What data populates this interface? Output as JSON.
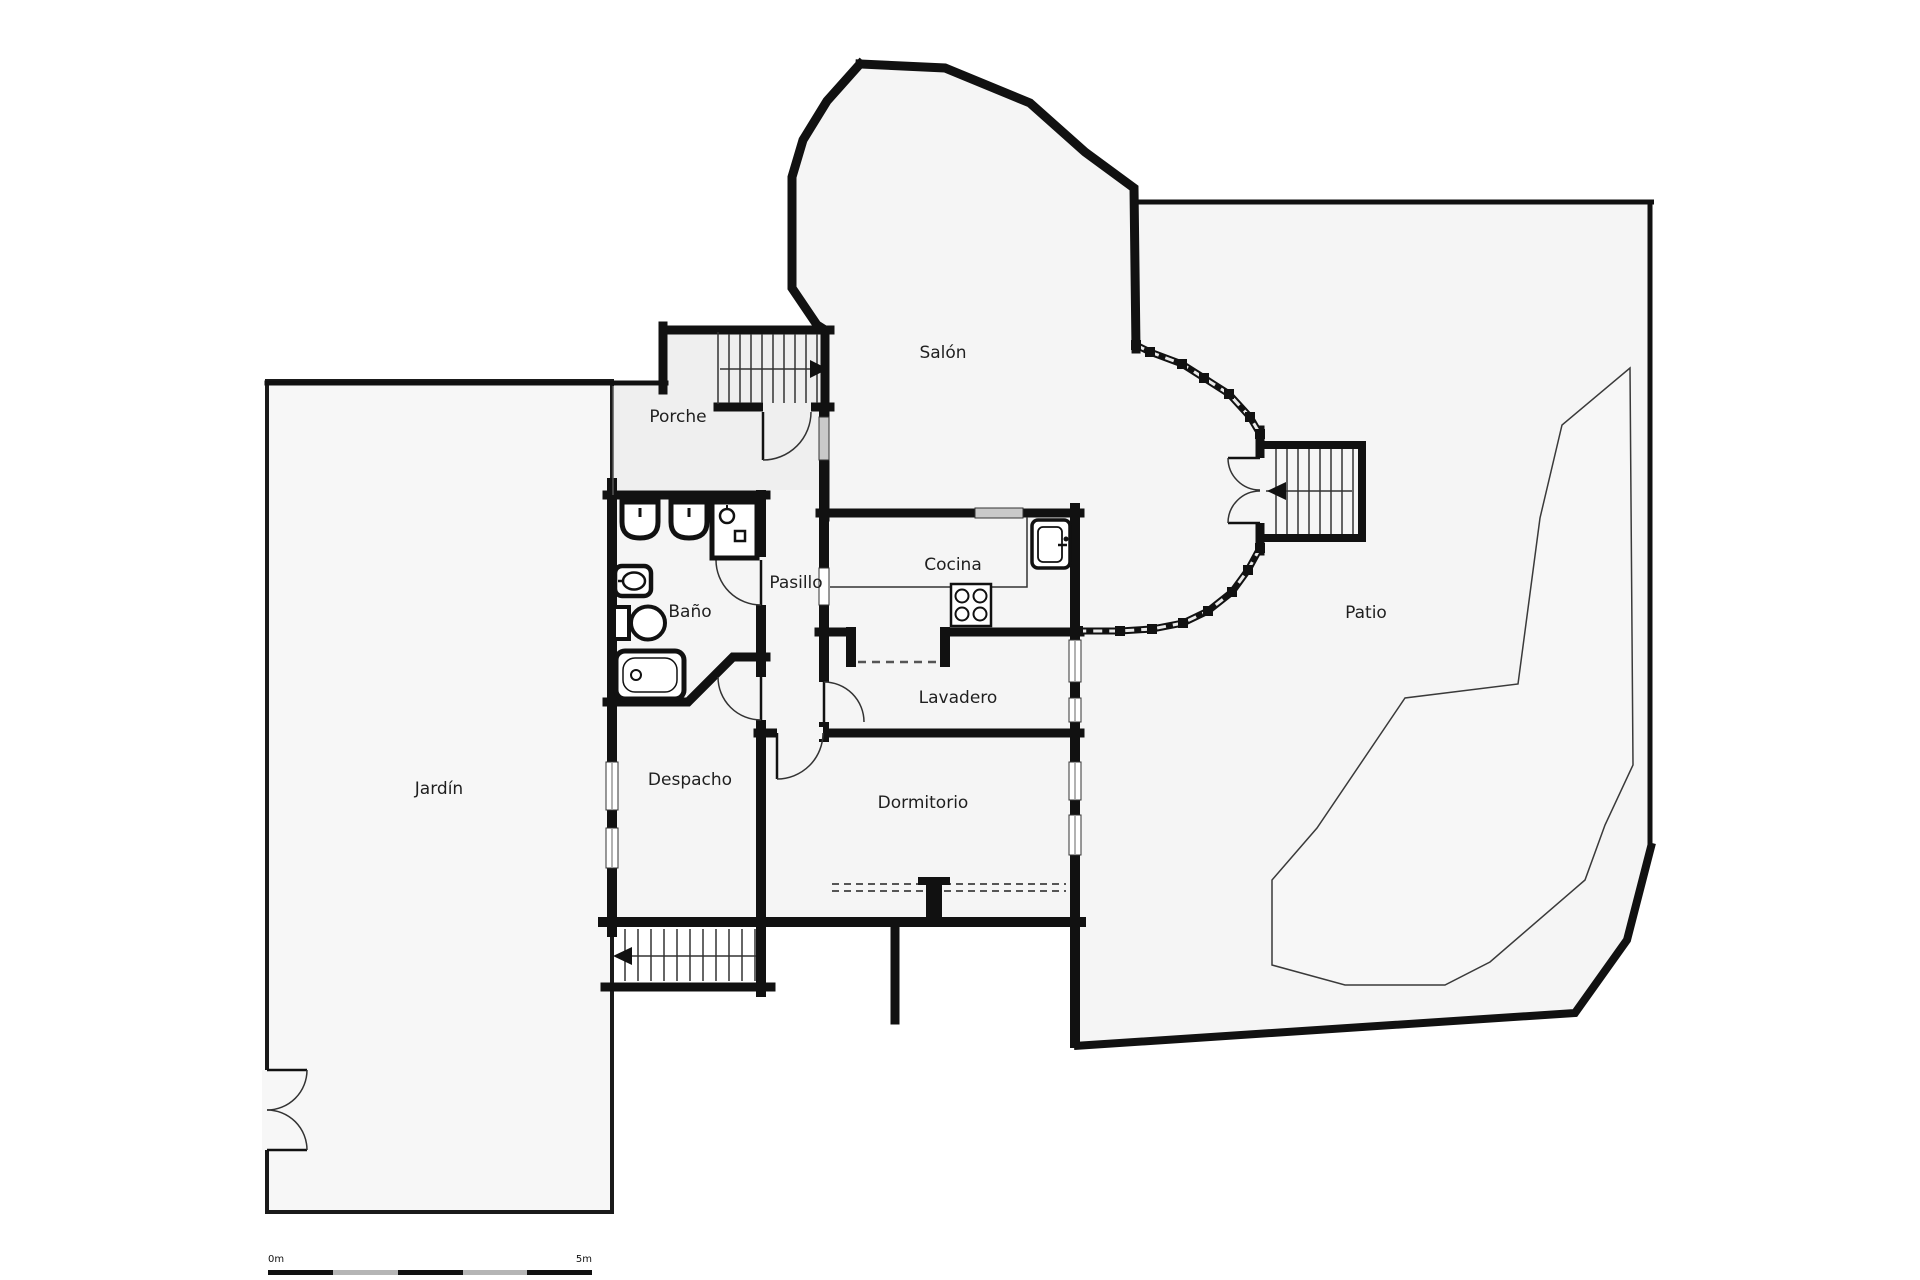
{
  "document": {
    "type": "floor-plan"
  },
  "rooms": {
    "salon": {
      "label": "Salón"
    },
    "porche": {
      "label": "Porche"
    },
    "pasillo": {
      "label": "Pasillo"
    },
    "cocina": {
      "label": "Cocina"
    },
    "bano": {
      "label": "Baño"
    },
    "lavadero": {
      "label": "Lavadero"
    },
    "jardin": {
      "label": "Jardín"
    },
    "despacho": {
      "label": "Despacho"
    },
    "dormitorio": {
      "label": "Dormitorio"
    },
    "patio": {
      "label": "Patio"
    }
  },
  "scale_bar": {
    "start_label": "0m",
    "end_label": "5m"
  },
  "colors": {
    "wall": "#111111",
    "thin_line": "#333333",
    "room_fill": "#f5f5f5",
    "porch_fill": "#efefef",
    "garden_fill": "#f7f7f7",
    "window_glass": "#c9c9c9",
    "scale_alt": "#b5b5b5",
    "background": "#ffffff"
  }
}
